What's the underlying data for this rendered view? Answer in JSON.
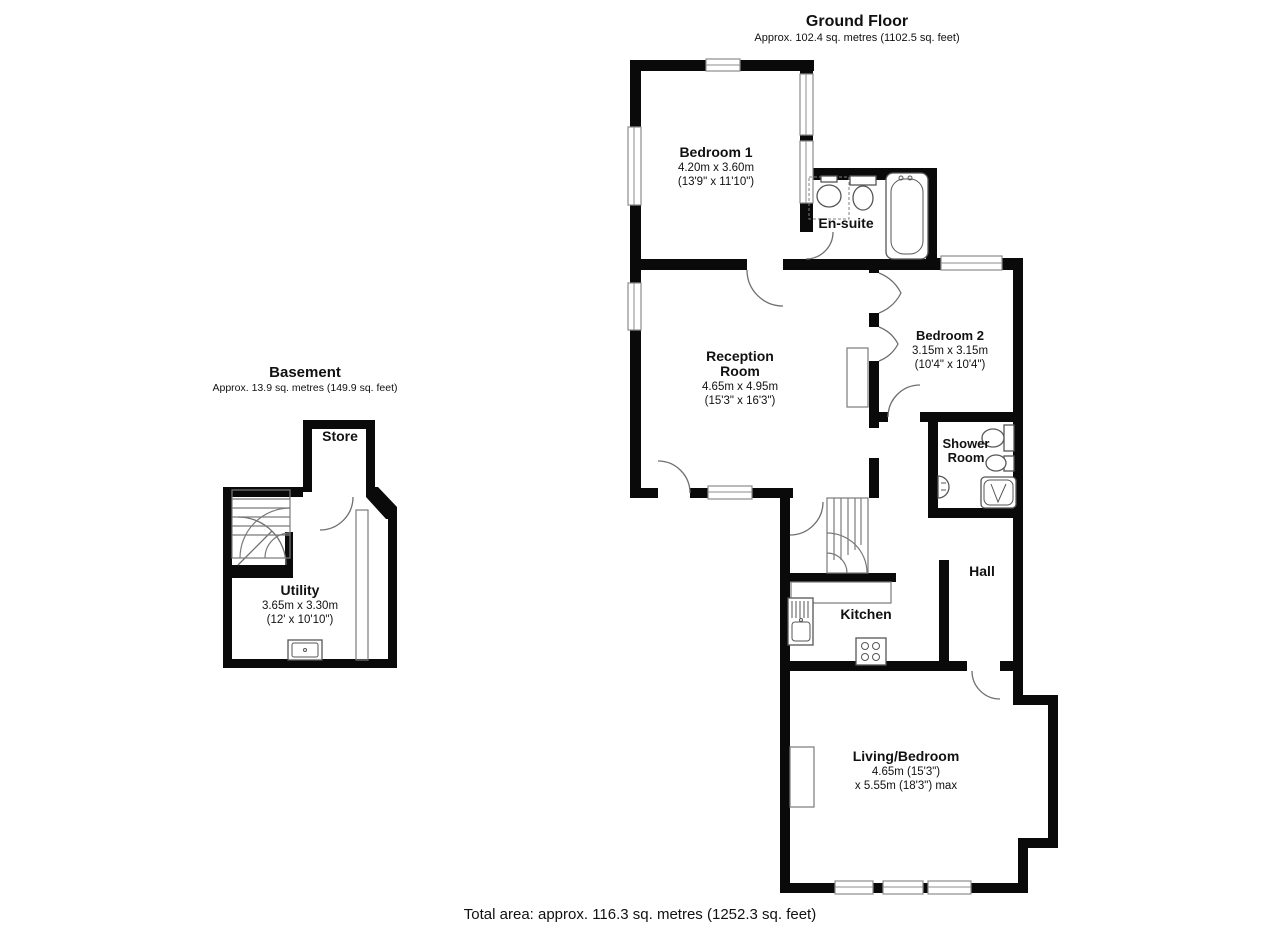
{
  "ground_floor": {
    "title": "Ground Floor",
    "subtitle": "Approx. 102.4 sq. metres (1102.5 sq. feet)",
    "rooms": {
      "bedroom1": {
        "name": "Bedroom 1",
        "dims_metric": "4.20m x 3.60m",
        "dims_imperial": "(13'9\" x 11'10\")"
      },
      "ensuite": {
        "name": "En-suite"
      },
      "reception": {
        "name_line1": "Reception",
        "name_line2": "Room",
        "dims_metric": "4.65m x 4.95m",
        "dims_imperial": "(15'3\" x 16'3\")"
      },
      "bedroom2": {
        "name": "Bedroom 2",
        "dims_metric": "3.15m x 3.15m",
        "dims_imperial": "(10'4\" x 10'4\")"
      },
      "shower_room": {
        "name_line1": "Shower",
        "name_line2": "Room"
      },
      "hall": {
        "name": "Hall"
      },
      "kitchen": {
        "name": "Kitchen"
      },
      "living_bedroom": {
        "name": "Living/Bedroom",
        "dims_line1": "4.65m (15'3\")",
        "dims_line2": "x 5.55m (18'3\") max"
      }
    }
  },
  "basement": {
    "title": "Basement",
    "subtitle": "Approx. 13.9 sq. metres (149.9 sq. feet)",
    "rooms": {
      "store": {
        "name": "Store"
      },
      "utility": {
        "name": "Utility",
        "dims_metric": "3.65m x 3.30m",
        "dims_imperial": "(12' x 10'10\")"
      }
    }
  },
  "footer": {
    "total_area": "Total area: approx. 116.3 sq. metres (1252.3 sq. feet)"
  },
  "icons": {
    "ensuite_fixtures": [
      "shower-enclosure",
      "wash-basin",
      "toilet",
      "bathtub"
    ],
    "shower_room_fixtures": [
      "toilet",
      "bidet",
      "wash-basin",
      "shower-tray"
    ],
    "kitchen_fixtures": [
      "sink-drainer-unit",
      "hob"
    ],
    "utility_fixtures": [
      "sink"
    ],
    "stairs": [
      "ground-floor-staircase",
      "basement-staircase"
    ]
  },
  "colors": {
    "wall": "#0a0a0a",
    "background": "#ffffff",
    "fixture_outline": "#565656"
  }
}
